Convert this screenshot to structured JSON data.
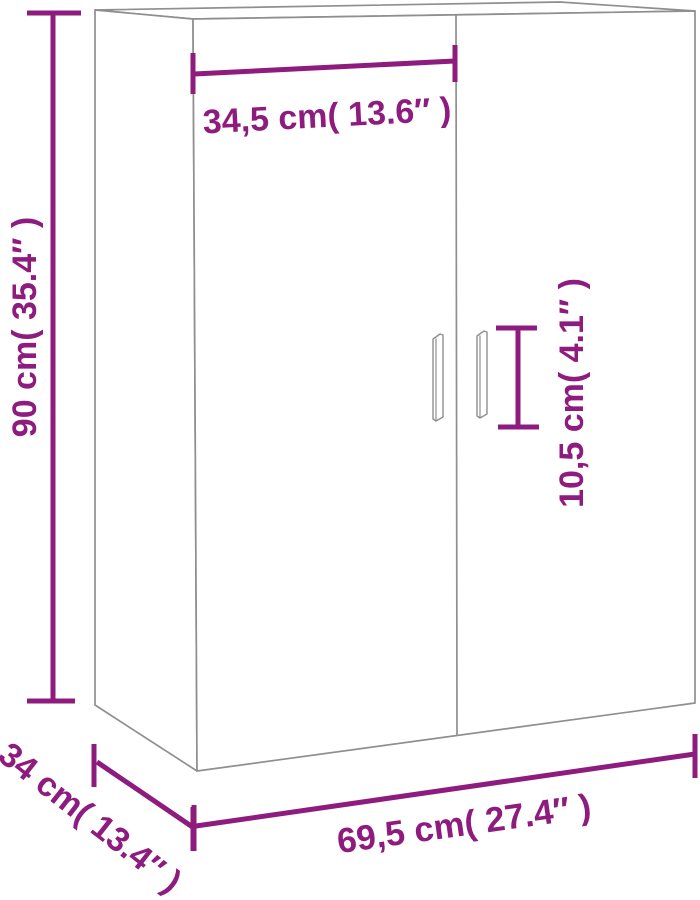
{
  "colors": {
    "dimension_annotation": "#8e1b7e",
    "cabinet_outline": "#8f8f8f",
    "background": "#ffffff"
  },
  "diagram": {
    "kind": "furniture-dimension-diagram",
    "dimensions": {
      "door_width": {
        "label": "34,5 cm( 13.6″ )",
        "value_cm": "34,5",
        "value_in": "13.6"
      },
      "height": {
        "label": "90 cm( 35.4″ )",
        "value_cm": "90",
        "value_in": "35.4"
      },
      "handle_length": {
        "label": "10,5 cm( 4.1″ )",
        "value_cm": "10,5",
        "value_in": "4.1"
      },
      "total_width": {
        "label": "69,5 cm( 27.4″ )",
        "value_cm": "69,5",
        "value_in": "27.4"
      },
      "depth": {
        "label": "34 cm( 13.4″ )",
        "value_cm": "34",
        "value_in": "13.4"
      }
    }
  }
}
